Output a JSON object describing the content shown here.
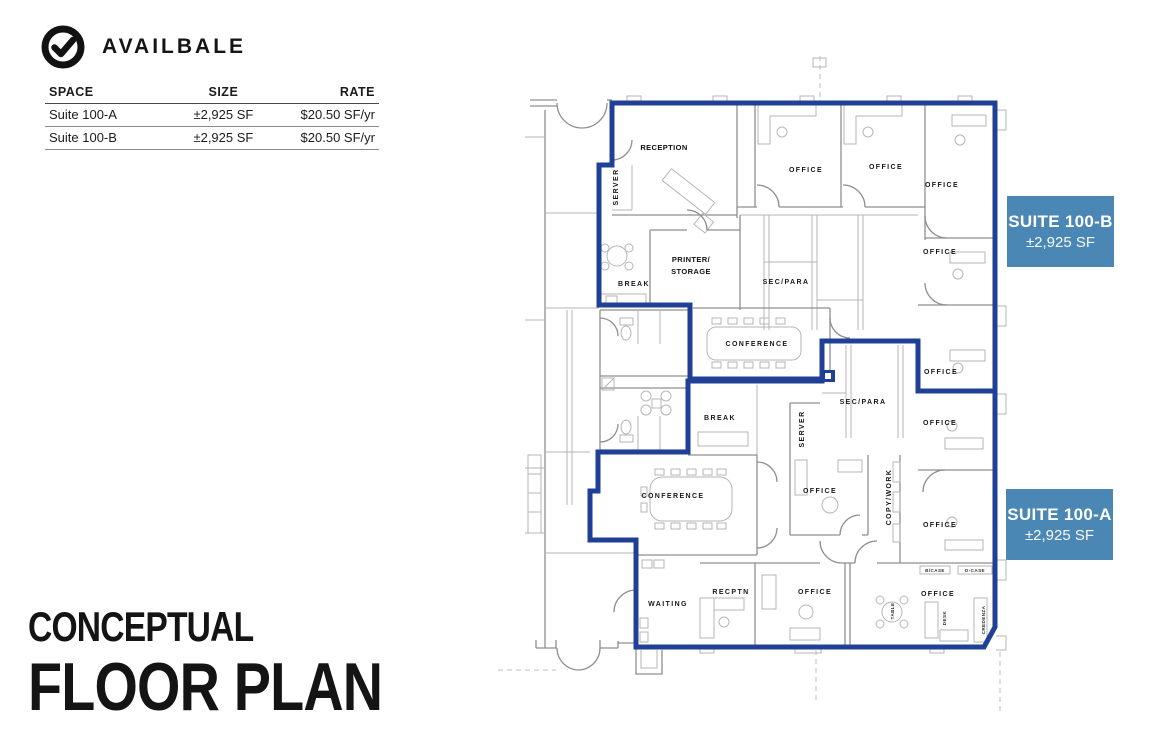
{
  "availability": {
    "title": "AVAILBALE",
    "icon": "check-circle-icon",
    "table": {
      "headers": [
        "SPACE",
        "SIZE",
        "RATE"
      ],
      "rows": [
        {
          "space": "Suite 100-A",
          "size": "±2,925 SF",
          "rate": "$20.50 SF/yr"
        },
        {
          "space": "Suite 100-B",
          "size": "±2,925 SF",
          "rate": "$20.50 SF/yr"
        }
      ]
    }
  },
  "title": {
    "line1": "CONCEPTUAL",
    "line2": "FLOOR PLAN"
  },
  "floor_plan": {
    "badges": [
      {
        "label": "SUITE 100-B",
        "size": "±2,925 SF"
      },
      {
        "label": "SUITE 100-A",
        "size": "±2,925 SF"
      }
    ],
    "labels": {
      "reception": "RECEPTION",
      "office": "OFFICE",
      "sec_para": "SEC/PARA",
      "printer_line1": "PRINTER/",
      "printer_line2": "STORAGE",
      "break": "BREAK",
      "conference": "CONFERENCE",
      "server": "SERVER",
      "copy_work": "COPY/WORK",
      "waiting": "WAITING",
      "recptn": "RECPTN",
      "bcase": "B/CASE",
      "dcase": "D-CASE",
      "table": "TABLE",
      "desk": "DESK",
      "credenza": "CREDENZA"
    },
    "colors": {
      "boundary": "#1f4096",
      "badge": "#4a87b5"
    }
  }
}
